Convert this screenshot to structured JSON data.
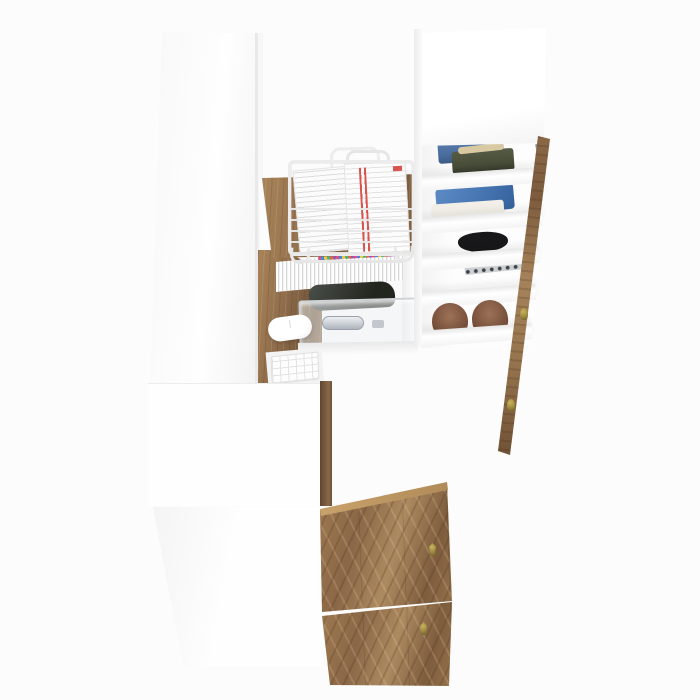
{
  "scene": {
    "description": "Top-down 3D product render of an open white wardrobe system with a fold-out oak desk, wire document basket with papers, row of books, keyboard and mouse, a white shelf column holding folded clothes and a pair of brown shoes, an open oak door seen edge-on, and two oak-grain doors below",
    "background": "#fcfcfc",
    "objects": {
      "left_panel": {
        "label": "white wardrobe tall panel (top view)"
      },
      "mid_panel": {
        "label": "white cabinet middle panel"
      },
      "bottom_panel": {
        "label": "white cabinet bottom panel"
      },
      "desk_top": {
        "label": "oak desk surface"
      },
      "desk_return": {
        "label": "oak desk return with rounded corner"
      },
      "desk_side": {
        "label": "oak desk side edge"
      },
      "hutch": {
        "label": "white under-desk hutch interior"
      },
      "books": {
        "label": "row of books with colored page tops"
      },
      "bag": {
        "label": "dark storage pouch"
      },
      "drawer": {
        "label": "clear acrylic drawer with metal handle"
      },
      "mouse": {
        "label": "white computer mouse"
      },
      "keyboard": {
        "label": "white keyboard on pull-out tray"
      },
      "basket": {
        "label": "white wire basket holding documents"
      },
      "papers": {
        "label": "documents with red stripes"
      },
      "unit_top": {
        "label": "white shelf unit top panel"
      },
      "shelves": {
        "label": "white shelf boards"
      },
      "jeans": {
        "label": "folded blue jeans"
      },
      "olive": {
        "label": "folded olive garment"
      },
      "strap": {
        "label": "beige strap"
      },
      "denim_shirt": {
        "label": "folded blue denim shirt"
      },
      "white_cloth": {
        "label": "folded white cloth"
      },
      "black_garment": {
        "label": "folded black garment"
      },
      "dotted_fabric": {
        "label": "gray dotted fabric"
      },
      "shoes": {
        "label": "pair of brown flat shoes"
      },
      "open_door": {
        "label": "open oak door seen edge-on with brass knobs"
      },
      "door_upper": {
        "label": "oak wardrobe door upper"
      },
      "door_lower": {
        "label": "oak wardrobe door lower"
      },
      "knobs": {
        "label": "small brass knob"
      },
      "hinges": {
        "label": "metal hinge"
      }
    }
  },
  "palette": {
    "bg": "#fcfcfc",
    "panel_white": "#fdfdfd",
    "panel_shadow": "#ececec",
    "wood_mid": "#8e6c4b",
    "wood_light": "#a98459",
    "wood_dark": "#6f5338",
    "wood_edge_light": "#c9a26b",
    "brass_knob": "#9a8a3f",
    "denim_blue": "#4a6d9e",
    "denim_blue2": "#4878b4",
    "olive_green": "#474c38",
    "beige_strap": "#d9c9a2",
    "cloth_white": "#f2efe8",
    "black_garment": "#18181a",
    "dot_fabric_base": "#ccd0d3",
    "dot_fabric_dot": "#3c4148",
    "shoe_brown": "#7a513c",
    "paper_red": "#d9534f",
    "wire_gray": "#ececec",
    "metal_gray": "#9aa2aa"
  }
}
